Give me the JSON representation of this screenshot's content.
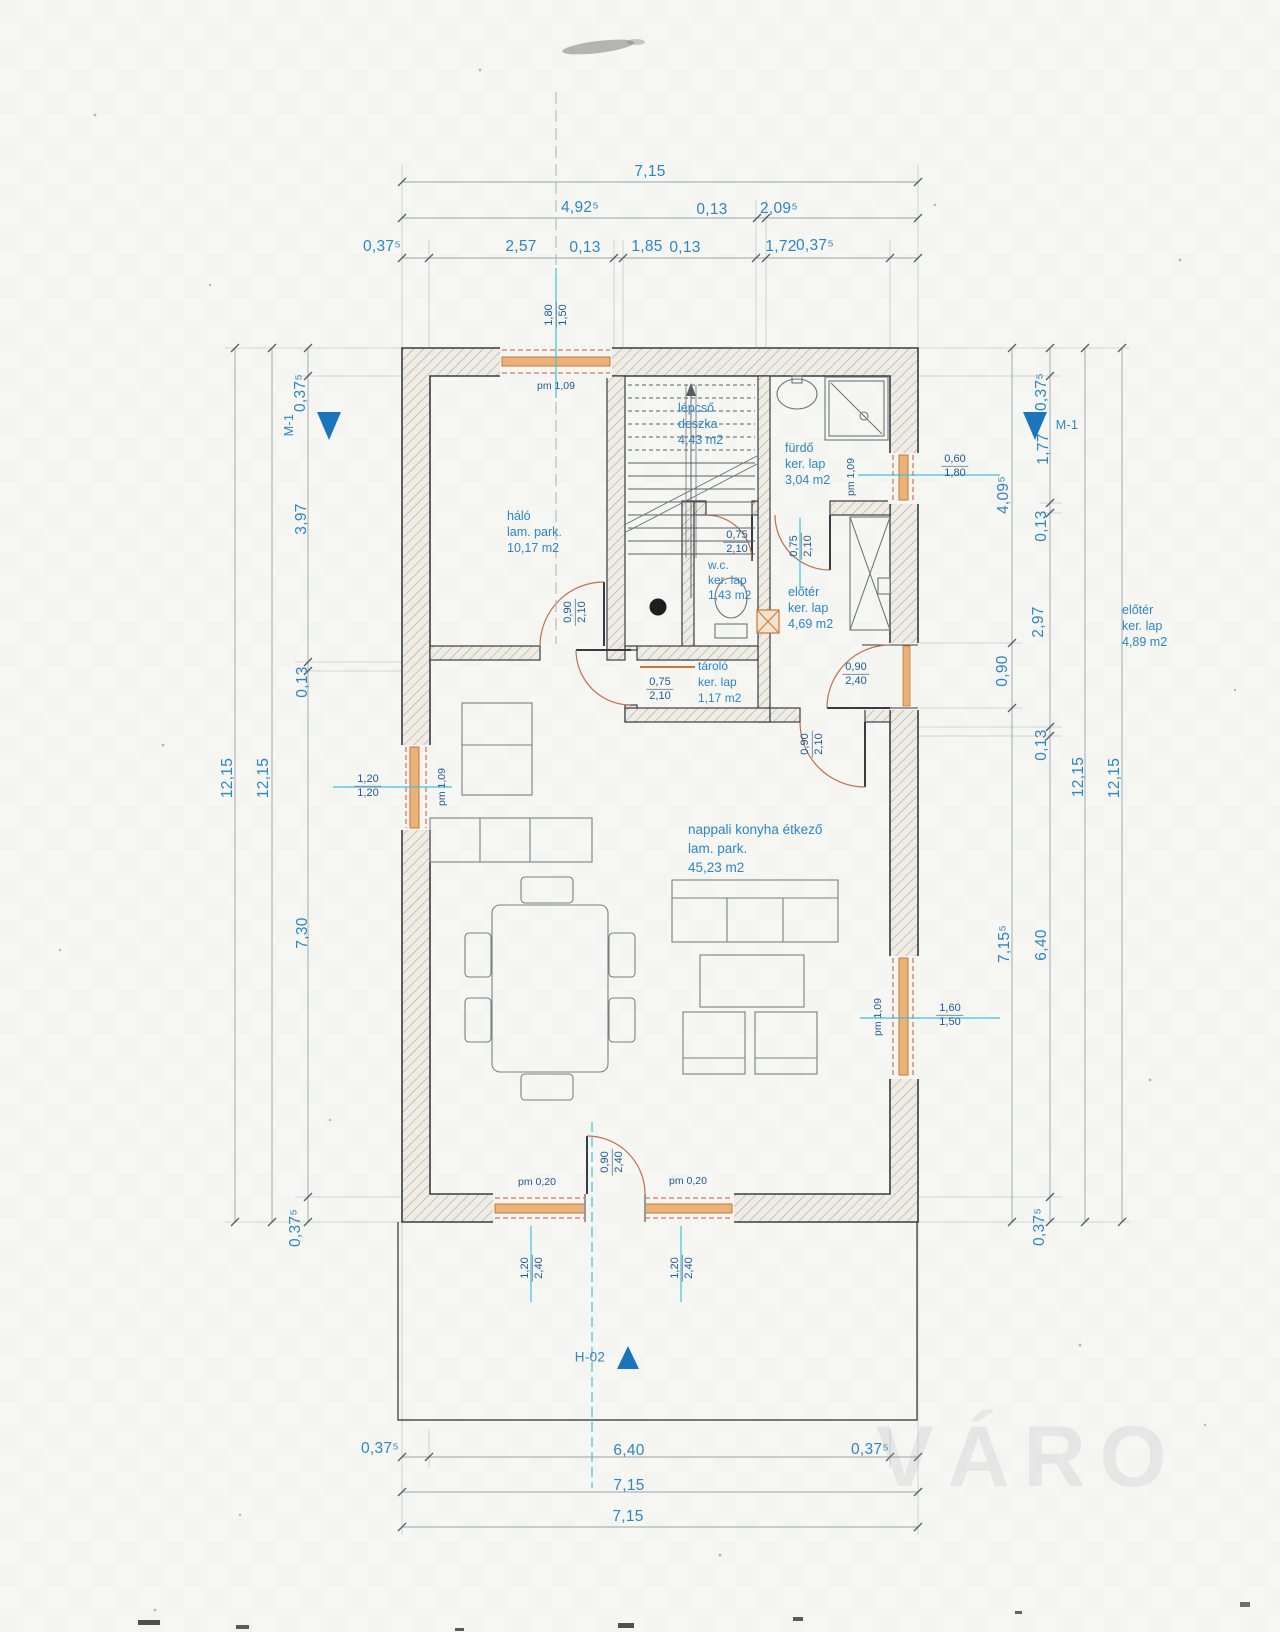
{
  "colors": {
    "dim_blue": "#2e86c1",
    "detail_navy": "#1f5a94",
    "centerline_cyan": "#3fc0df",
    "window_orange": "#c9782f",
    "opening_red": "#cd5240",
    "wall_outline": "#383c42",
    "marker_blue": "#1c75bc"
  },
  "rooms": {
    "halo": [
      "háló",
      "lam. park.",
      "10,17 m2"
    ],
    "lepcso": [
      "lépcső",
      "deszka",
      "4,43 m2"
    ],
    "furdo": [
      "fürdő",
      "ker. lap",
      "3,04 m2"
    ],
    "wc": [
      "w.c.",
      "ker. lap",
      "1,43 m2"
    ],
    "eloter": [
      "előtér",
      "ker. lap",
      "4,69 m2"
    ],
    "tarolo": [
      "tároló",
      "ker. lap",
      "1,17 m2"
    ],
    "nappali": [
      "nappali konyha étkező",
      "lam. park.",
      "45,23 m2"
    ],
    "eloter2": [
      "előtér",
      "ker. lap",
      "4,89 m2"
    ]
  },
  "dims_top": {
    "row1": "7,15",
    "row2": [
      "4,92⁵",
      "0,13",
      "2,09⁵"
    ],
    "row3": [
      "0,37⁵",
      "2,57",
      "0,13",
      "1,85",
      "0,13",
      "1,72",
      "0,37⁵"
    ]
  },
  "dims_bottom": {
    "row1": [
      "0,37⁵",
      "6,40",
      "0,37⁵"
    ],
    "row2": "7,15",
    "row3": "7,15"
  },
  "dims_left": {
    "v1": "12,15",
    "v2": "12,15",
    "v3": [
      "0,37⁵",
      "3,97",
      "0,13",
      "7,30",
      "0,37⁵"
    ]
  },
  "dims_right": {
    "v1": [
      "4,09⁵",
      "0,90",
      "7,15⁵"
    ],
    "v2": [
      "0,37⁵",
      "1,77",
      "0,13",
      "2,97",
      "0,13",
      "6,40",
      "0,37⁵"
    ],
    "v3": "12,15",
    "v4": "12,15"
  },
  "openings": {
    "top_window": {
      "pm": "pm 1,09",
      "a": "1,80",
      "b": "1,50"
    },
    "left_window": {
      "pm": "pm 1,09",
      "a": "1,20",
      "b": "1,20"
    },
    "furdo_window": {
      "pm": "pm 1,09",
      "a": "0,60",
      "b": "1,80"
    },
    "right_window": {
      "pm": "pm 1,09",
      "a": "1,60",
      "b": "1,50"
    },
    "bottom_window_left": {
      "pm": "pm 0,20",
      "a": "1,20",
      "b": "2,40"
    },
    "bottom_window_right": {
      "pm": "pm 0,20",
      "a": "1,20",
      "b": "2,40"
    },
    "bottom_door": {
      "a": "0,90",
      "b": "2,40"
    },
    "halo_door": {
      "a": "0,90",
      "b": "2,10"
    },
    "wc_door": {
      "a": "0,75",
      "b": "2,10"
    },
    "furdo_door": {
      "a": "0,75",
      "b": "2,10"
    },
    "tarolo_door": {
      "a": "0,75",
      "b": "2,10"
    },
    "eloter_door": {
      "a": "0,90",
      "b": "2,10"
    },
    "entry_door": {
      "a": "0,90",
      "b": "2,40"
    }
  },
  "markers": {
    "m1_left": "M-1",
    "m1_right": "M-1",
    "h02": "H-02"
  },
  "watermark": "VÁRO"
}
